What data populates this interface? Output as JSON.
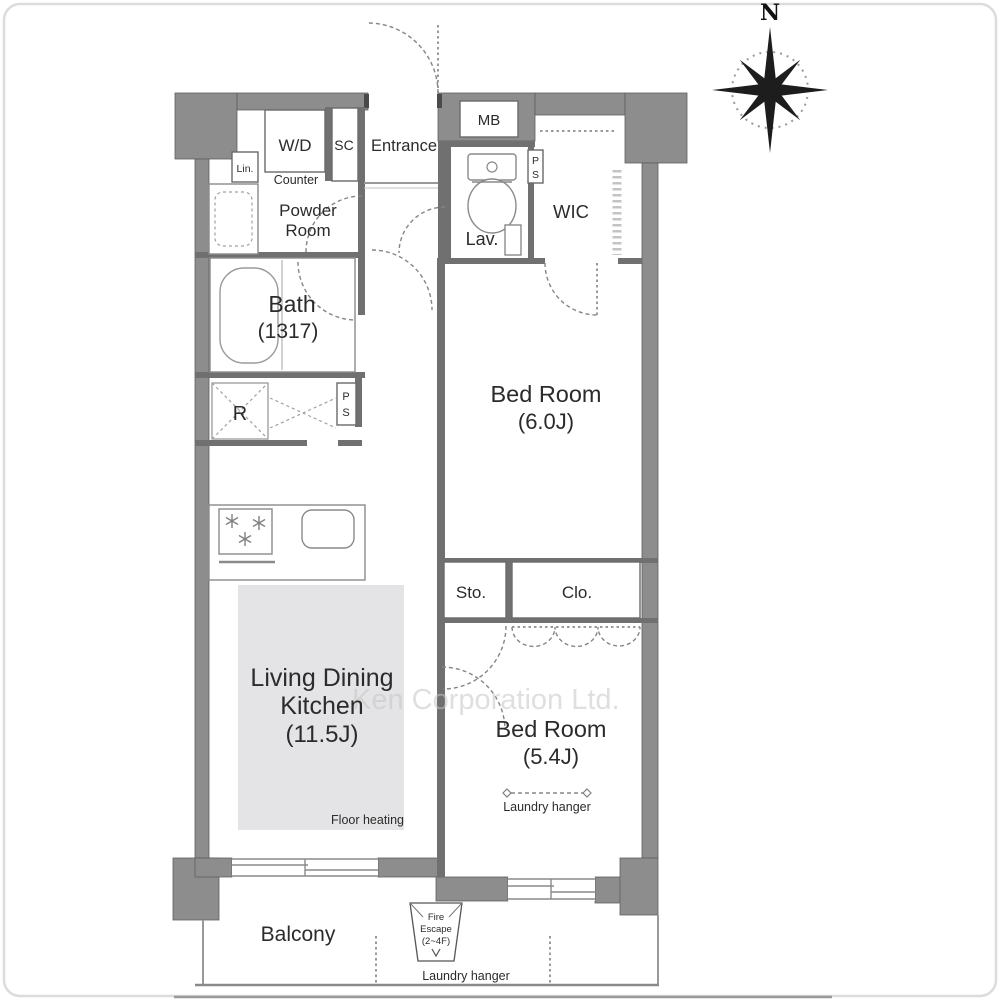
{
  "title": "Apartment floor plan",
  "compass": {
    "north": "N"
  },
  "watermark": "Ken Corporation Ltd.",
  "labels": {
    "wd": "W/D",
    "counter": "Counter",
    "powder_line1": "Powder",
    "powder_line2": "Room",
    "lin": "Lin.",
    "sc": "SC",
    "entrance": "Entrance",
    "mb": "MB",
    "lav": "Lav.",
    "ps_letter1": "P",
    "ps_letter2": "S",
    "wic": "WIC",
    "bath_line1": "Bath",
    "bath_line2": "(1317)",
    "refrigerator": "R",
    "bedroom1_line1": "Bed Room",
    "bedroom1_line2": "(6.0J)",
    "sto": "Sto.",
    "clo": "Clo.",
    "bedroom2_line1": "Bed Room",
    "bedroom2_line2": "(5.4J)",
    "laundry_hanger_bedroom": "Laundry hanger",
    "ldk_line1": "Living Dining",
    "ldk_line2": "Kitchen",
    "ldk_line3": "(11.5J)",
    "floor_heating": "Floor heating",
    "balcony": "Balcony",
    "fire_escape_line1": "Fire",
    "fire_escape_line2": "Escape",
    "fire_escape_line3": "(2~4F)",
    "laundry_hanger_balcony": "Laundry hanger"
  },
  "colors": {
    "outer_wall": "#8d8d8d",
    "inner_wall": "#707070",
    "floor_heating_fill": "#e4e4e6",
    "text": "#2b2b2b",
    "watermark": "#c6c6c6"
  }
}
